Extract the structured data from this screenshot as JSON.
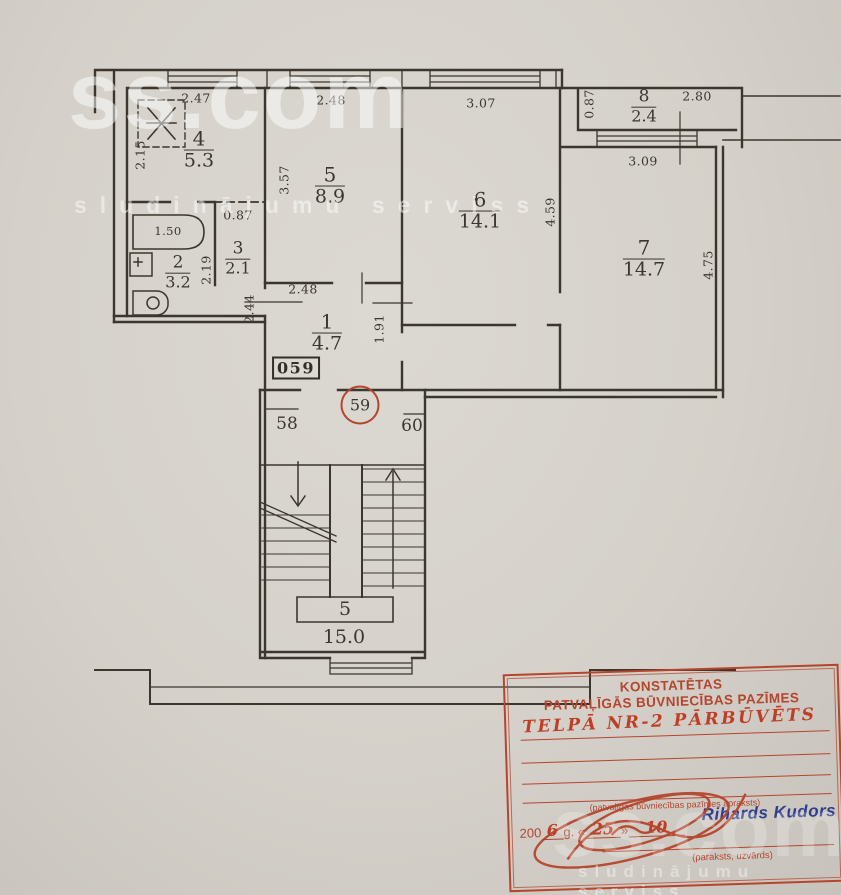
{
  "watermark": {
    "brand": "ss.com",
    "tagline": "sludinājumu serviss"
  },
  "plan": {
    "apartment_number": "059",
    "rooms": [
      {
        "number": "1",
        "area": "4.7"
      },
      {
        "number": "2",
        "area": "3.2"
      },
      {
        "number": "3",
        "area": "2.1"
      },
      {
        "number": "4",
        "area": "5.3"
      },
      {
        "number": "5",
        "area": "8.9"
      },
      {
        "number": "6",
        "area": "14.1"
      },
      {
        "number": "7",
        "area": "14.7"
      },
      {
        "number": "8",
        "area": "2.4"
      }
    ],
    "dims": {
      "room4_width": "2.47",
      "room4_depth": "2.15",
      "room5_width": "2.48",
      "room5_depth": "3.57",
      "room6_width": "3.07",
      "room6_depth": "4.59",
      "room7_width": "3.09",
      "room7_depth": "4.75",
      "room8_width": "2.80",
      "room8_depth": "0.87",
      "room3_width": "0.87",
      "room2_depth": "2.19",
      "room3_depth": "2.44",
      "room1_width": "2.48",
      "room1_depth": "1.91",
      "bathtub": "1.50"
    },
    "landing": {
      "left_apartment": "58",
      "this_apartment": "59",
      "right_apartment": "60"
    },
    "staircase": {
      "number": "5",
      "area": "15.0"
    }
  },
  "stamp": {
    "title_line1": "KONSTATĒTAS",
    "title_line2": "PATVAĻĪGĀS BŪVNIECĪBAS PAZĪMES",
    "handwritten_text": "TELPĀ NR-2 PĀRBŪVĒTS",
    "description_caption": "(patvaļīgas būvniecības pazīmes apraksts)",
    "date_prefix": "200",
    "date_year": "6",
    "date_g": "g. «",
    "date_day": "25",
    "quote_close": "»",
    "date_month": "10",
    "inspector_name": "Rihards Kudors",
    "signature_caption": "(paraksts, uzvārds)"
  },
  "colors": {
    "paper": "#d5d1ca",
    "ink": "#3b372f",
    "stamp_red": "#b5452c",
    "name_blue": "#2f3e8e"
  }
}
